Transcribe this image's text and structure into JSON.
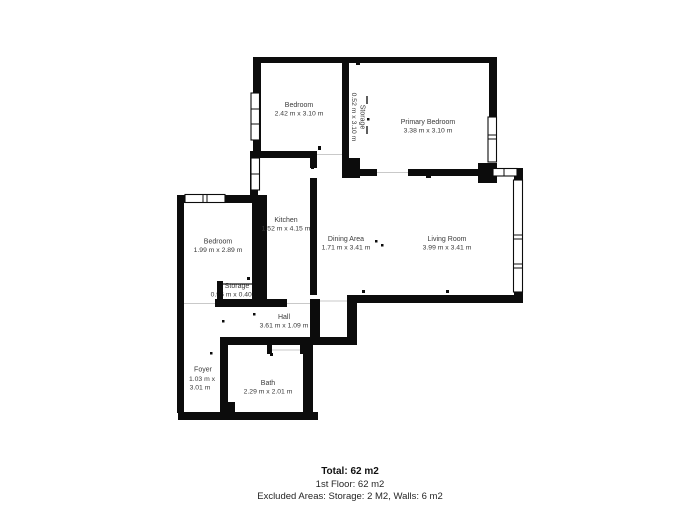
{
  "plan": {
    "rooms": [
      {
        "id": "bedroom-top",
        "name": "Bedroom",
        "dims": "2.42 m x 3.10 m"
      },
      {
        "id": "storage-closet",
        "name": "Storage",
        "dims": "0.52 m x 3.10 m"
      },
      {
        "id": "primary-bedroom",
        "name": "Primary Bedroom",
        "dims": "3.38 m x 3.10 m"
      },
      {
        "id": "kitchen",
        "name": "Kitchen",
        "dims": "1.52 m x 4.15 m"
      },
      {
        "id": "bedroom-left",
        "name": "Bedroom",
        "dims": "1.99 m x 2.89 m"
      },
      {
        "id": "dining-area",
        "name": "Dining Area",
        "dims": "1.71 m x 3.41 m"
      },
      {
        "id": "living-room",
        "name": "Living Room",
        "dims": "3.99 m x 3.41 m"
      },
      {
        "id": "storage-small",
        "name": "Storage",
        "dims": "0.96 m x 0.40 m"
      },
      {
        "id": "hall",
        "name": "Hall",
        "dims": "3.61 m x 1.09 m"
      },
      {
        "id": "foyer",
        "name": "Foyer",
        "dims_line1": "1.03 m x",
        "dims_line2": "3.01 m"
      },
      {
        "id": "bath",
        "name": "Bath",
        "dims": "2.29 m x 2.01 m"
      }
    ],
    "colors": {
      "wall": "#0c0c0c",
      "label": "#3a3a3a"
    }
  },
  "summary": {
    "total": "Total: 62 m2",
    "first_floor": "1st Floor: 62 m2",
    "excluded": "Excluded Areas: Storage: 2 M2, Walls: 6 m2"
  }
}
